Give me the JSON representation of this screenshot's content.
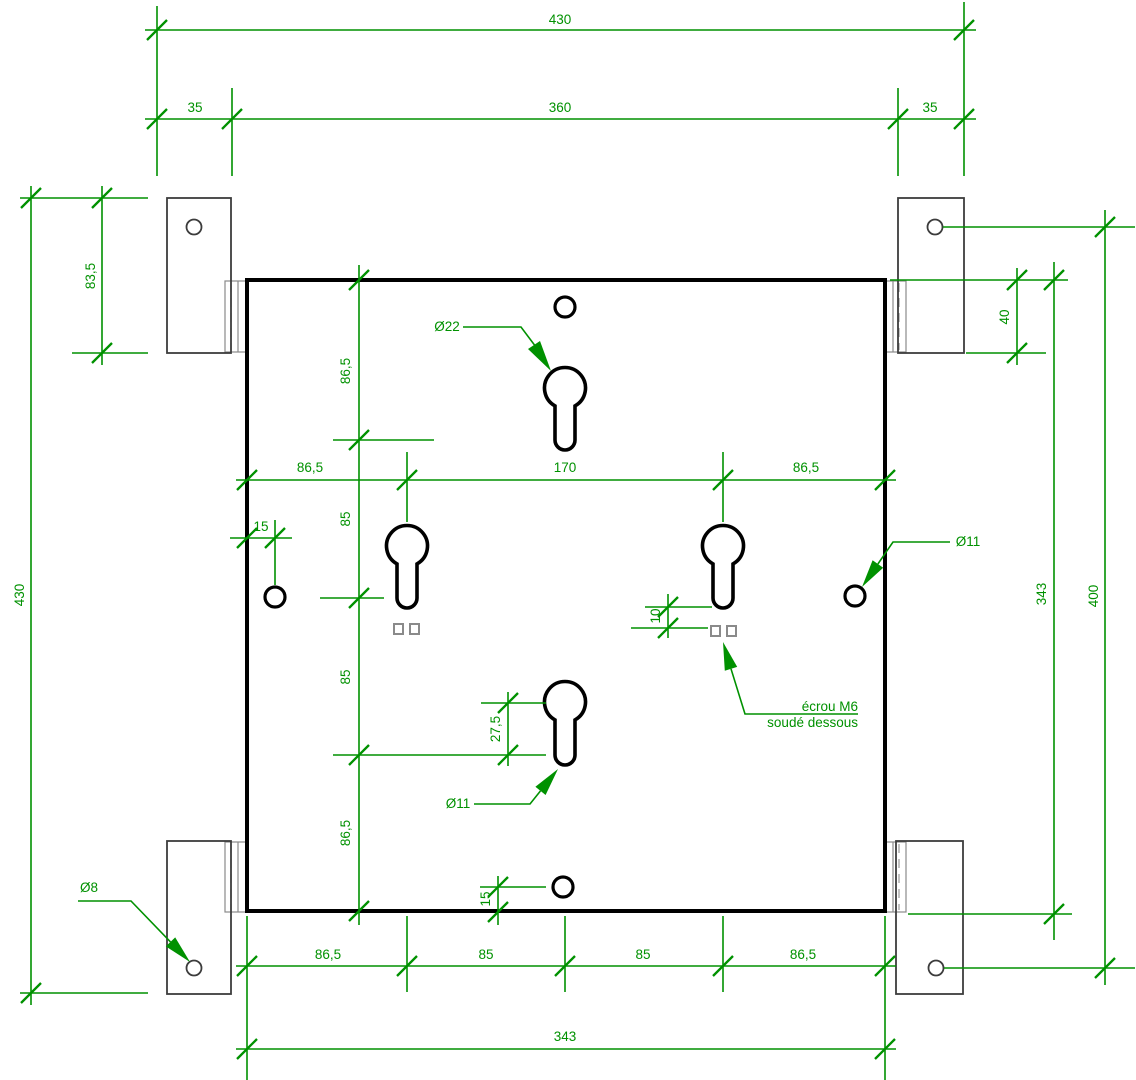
{
  "drawing_type": "mounting-plate technical drawing",
  "colors": {
    "dimension_green": "#009100",
    "plate_outline": "#000000",
    "bracket_gray": "#3c3c3c",
    "nut_gray": "#8a8a8a"
  },
  "dimensions": {
    "top_overall": "430",
    "top_between_tab_holes": "360",
    "top_tab_offset_left": "35",
    "top_tab_offset_right": "35",
    "left_overall": "430",
    "tab_height": "83,5",
    "right_tab_overlap": "40",
    "plate_height": "343",
    "tab_hole_span": "400",
    "col_chain": [
      "86,5",
      "85",
      "85",
      "86,5"
    ],
    "mid_row": [
      "86,5",
      "170",
      "86,5"
    ],
    "bottom_row": [
      "86,5",
      "85",
      "85",
      "86,5"
    ],
    "bottom_overall": "343",
    "edge_hole_offset_left": "15",
    "edge_hole_offset_bottom": "15",
    "keyhole_slot_length": "27,5",
    "nut_offset": "10"
  },
  "labels": {
    "keyhole_large_dia": "Ø22",
    "keyhole_stem_dia": "Ø11",
    "edge_hole_dia": "Ø11",
    "tab_hole_dia": "Ø8",
    "weld_note_line1": "écrou M6",
    "weld_note_line2": "soudé dessous"
  }
}
